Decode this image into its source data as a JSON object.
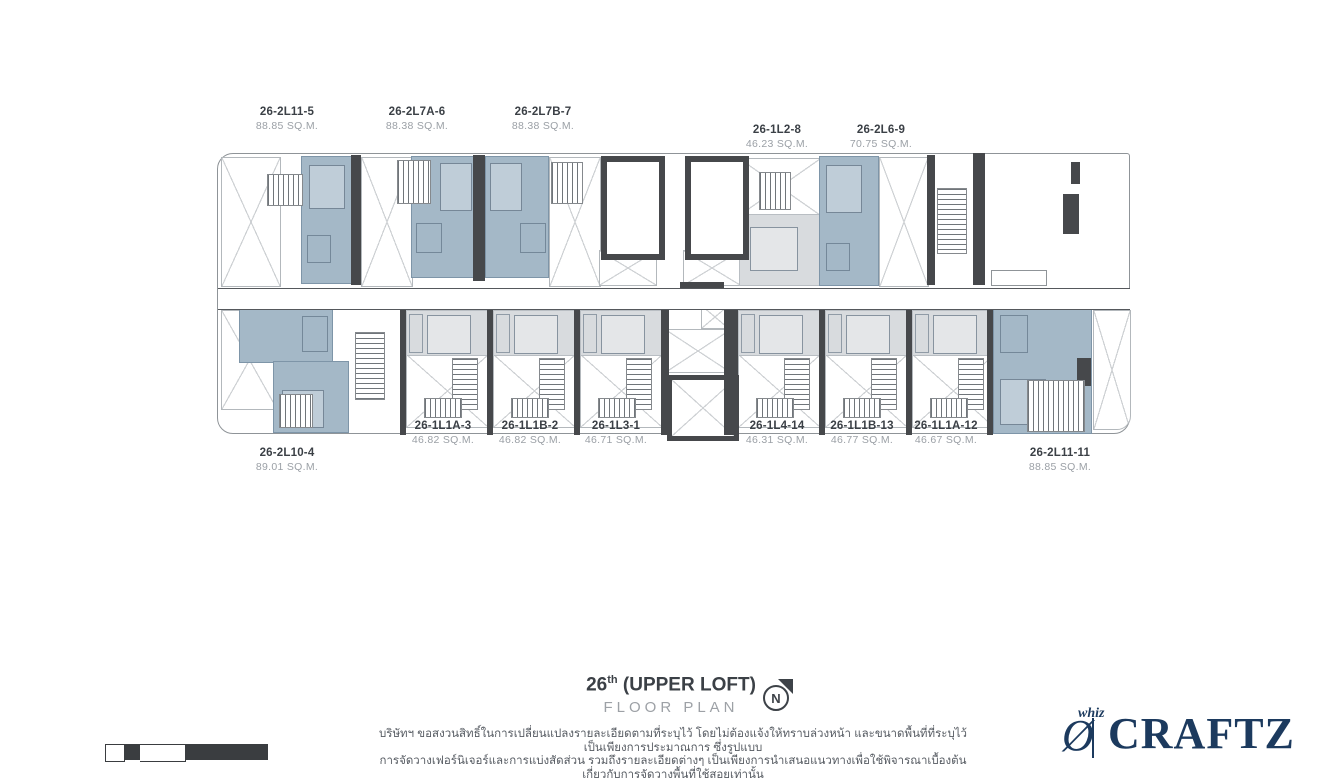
{
  "title": {
    "floor_number": "26",
    "floor_suffix": "th",
    "floor_name": " (UPPER LOFT)",
    "subtitle": "FLOOR PLAN"
  },
  "compass": {
    "letter": "N"
  },
  "units": [
    {
      "id": "26-2L11-5",
      "area": "88.85 SQ.M."
    },
    {
      "id": "26-2L7A-6",
      "area": "88.38 SQ.M."
    },
    {
      "id": "26-2L7B-7",
      "area": "88.38 SQ.M."
    },
    {
      "id": "26-1L2-8",
      "area": "46.23 SQ.M."
    },
    {
      "id": "26-2L6-9",
      "area": "70.75 SQ.M."
    },
    {
      "id": "26-2L10-4",
      "area": "89.01 SQ.M."
    },
    {
      "id": "26-1L1A-3",
      "area": "46.82 SQ.M."
    },
    {
      "id": "26-1L1B-2",
      "area": "46.82 SQ.M."
    },
    {
      "id": "26-1L3-1",
      "area": "46.71 SQ.M."
    },
    {
      "id": "26-1L4-14",
      "area": "46.31 SQ.M."
    },
    {
      "id": "26-1L1B-13",
      "area": "46.77 SQ.M."
    },
    {
      "id": "26-1L1A-12",
      "area": "46.67 SQ.M."
    },
    {
      "id": "26-2L11-11",
      "area": "88.85 SQ.M."
    }
  ],
  "disclaimer": {
    "line1": "บริษัทฯ ขอสงวนสิทธิ์ในการเปลี่ยนแปลงรายละเอียดตามที่ระบุไว้ โดยไม่ต้องแจ้งให้ทราบล่วงหน้า และขนาดพื้นที่ที่ระบุไว้เป็นเพียงการประมาณการ ซึ่งรูปแบบ",
    "line2": "การจัดวางเฟอร์นิเจอร์และการแบ่งสัดส่วน รวมถึงรายละเอียดต่างๆ เป็นเพียงการนำเสนอแนวทางเพื่อใช้พิจารณาเบื้องต้นเกี่ยวกับการจัดวางพื้นที่ใช้สอยเท่านั้น"
  },
  "logo": {
    "brand_top": "whiz",
    "brand_main": "CRAFTZ"
  },
  "colors": {
    "unit_highlight": "#a4b8c7",
    "unit_gray": "#d8dbde",
    "wall": "#46484b",
    "brand_navy": "#1c3a5e"
  }
}
